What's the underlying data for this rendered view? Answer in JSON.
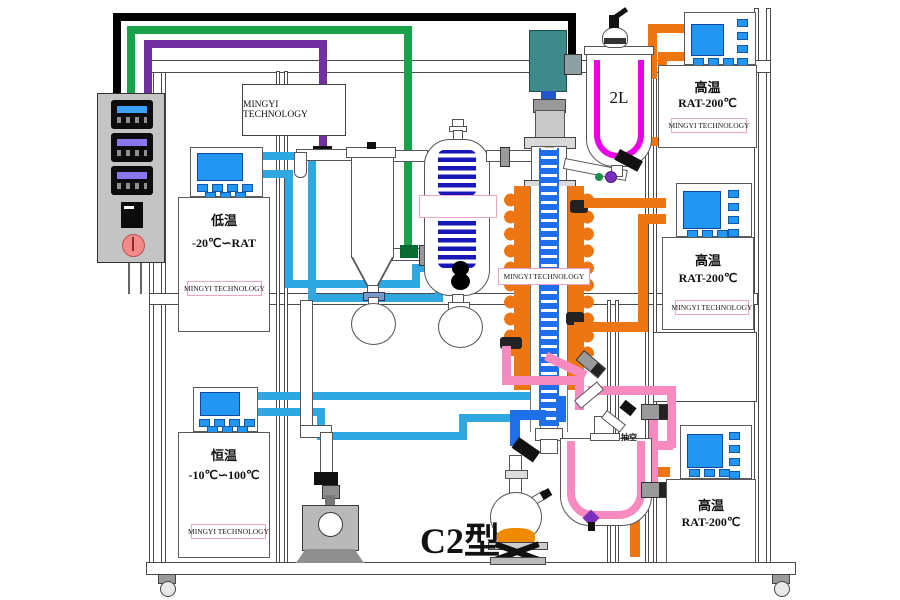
{
  "top_box": {
    "label": "MINGYI TECHNOLOGY"
  },
  "column": {
    "badge": "MINGYI TECHNOLOGY"
  },
  "vessel_2l": {
    "label": "2L"
  },
  "bottom_vessel": {
    "vacuum_port_label": "抽空"
  },
  "model_label": "C2型",
  "controllers": {
    "low_temp": {
      "name": "低温",
      "range": "-20℃∽RAT",
      "badge": "MINGYI TECHNOLOGY"
    },
    "constant_temp": {
      "name": "恒温",
      "range": "-10℃∽100℃",
      "badge": "MINGYI TECHNOLOGY"
    },
    "high_temp_top": {
      "name": "高温",
      "range": "RAT-200℃",
      "badge": "MINGYI TECHNOLOGY"
    },
    "high_temp_mid": {
      "name": "高温",
      "range": "RAT-200℃",
      "badge": "MINGYI TECHNOLOGY"
    },
    "high_temp_bottom": {
      "name": "高温",
      "range": "RAT-200℃"
    }
  },
  "colors": {
    "coolant_cyan": "#2FA8E1",
    "chiller_green": "#18A34A",
    "chiller_purple": "#7030A0",
    "hot_oil_orange": "#EE7612",
    "jacket_pink": "#F78BC0",
    "jacket_magenta": "#E800E8",
    "auger_blue": "#1F6FE8",
    "coil_navy": "#1818B8",
    "motor_teal": "#3E8A8A",
    "screen_blue": "#2196F3"
  }
}
